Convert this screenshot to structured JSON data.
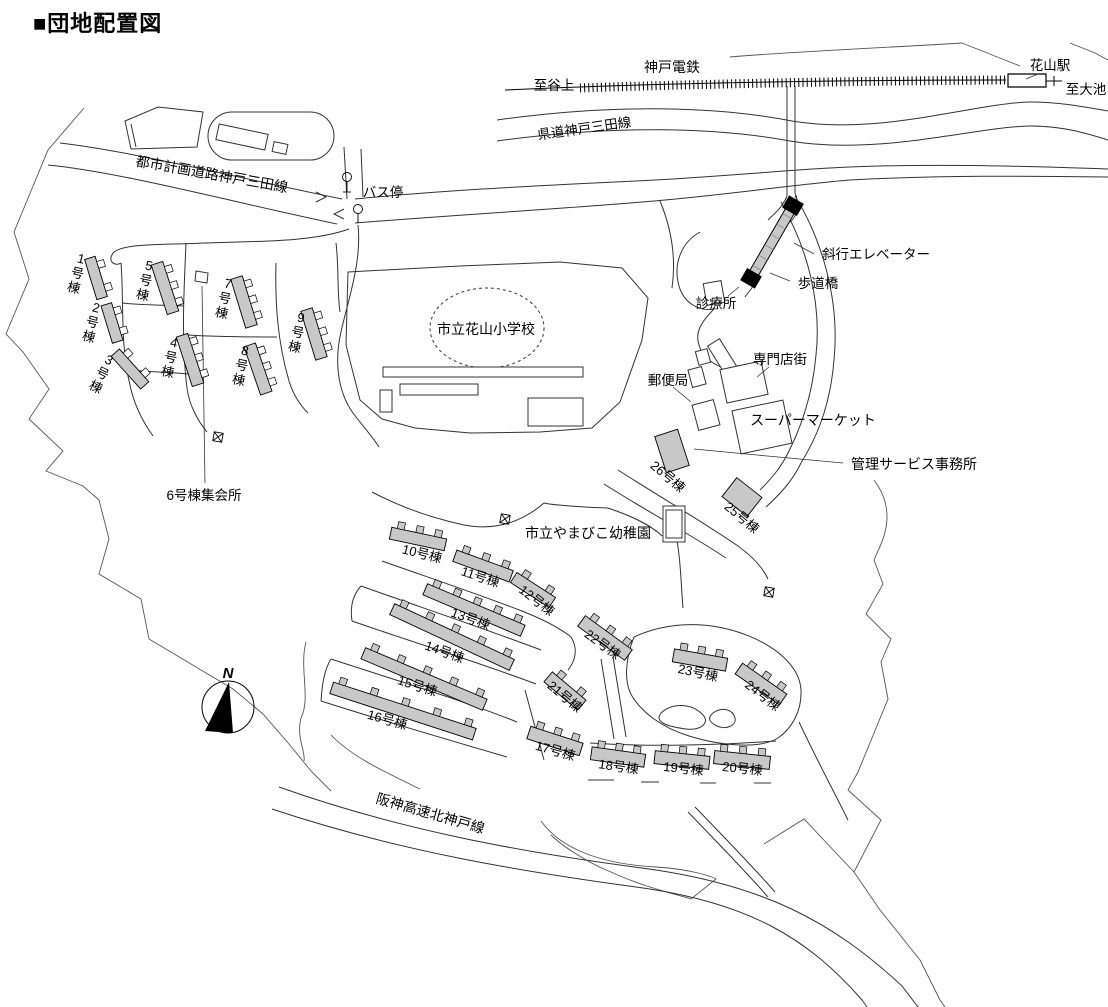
{
  "title": "■団地配置図",
  "railway": {
    "line_name": "神戸電鉄",
    "station": "花山駅",
    "direction_left": "至谷上",
    "direction_right": "至大池"
  },
  "roads": {
    "prefectural": "県道神戸三田線",
    "city_planning": "都市計画道路神戸三田線",
    "expressway": "阪神高速北神戸線"
  },
  "facilities": {
    "bus_stop": "バス停",
    "elementary_school": "市立花山小学校",
    "clinic": "診療所",
    "inclined_elevator": "斜行エレベーター",
    "pedestrian_bridge": "歩道橋",
    "shopping_arcade": "専門店街",
    "post_office": "郵便局",
    "supermarket": "スーパーマーケット",
    "management_office": "管理サービス事務所",
    "kindergarten": "市立やまびこ幼稚園",
    "building6_meeting_hall": "6号棟集会所"
  },
  "compass": {
    "north_label": "N"
  },
  "buildings": [
    {
      "label": "1号棟"
    },
    {
      "label": "2号棟"
    },
    {
      "label": "3号棟"
    },
    {
      "label": "4号棟"
    },
    {
      "label": "5号棟"
    },
    {
      "label": "7号棟"
    },
    {
      "label": "8号棟"
    },
    {
      "label": "9号棟"
    },
    {
      "label": "10号棟"
    },
    {
      "label": "11号棟"
    },
    {
      "label": "12号棟"
    },
    {
      "label": "13号棟"
    },
    {
      "label": "14号棟"
    },
    {
      "label": "15号棟"
    },
    {
      "label": "16号棟"
    },
    {
      "label": "17号棟"
    },
    {
      "label": "18号棟"
    },
    {
      "label": "19号棟"
    },
    {
      "label": "20号棟"
    },
    {
      "label": "21号棟"
    },
    {
      "label": "22号棟"
    },
    {
      "label": "23号棟"
    },
    {
      "label": "24号棟"
    },
    {
      "label": "25号棟"
    },
    {
      "label": "26号棟"
    }
  ],
  "colors": {
    "building_fill": "#c8c8c8",
    "line": "#333333",
    "text": "#000000",
    "background": "#ffffff"
  }
}
